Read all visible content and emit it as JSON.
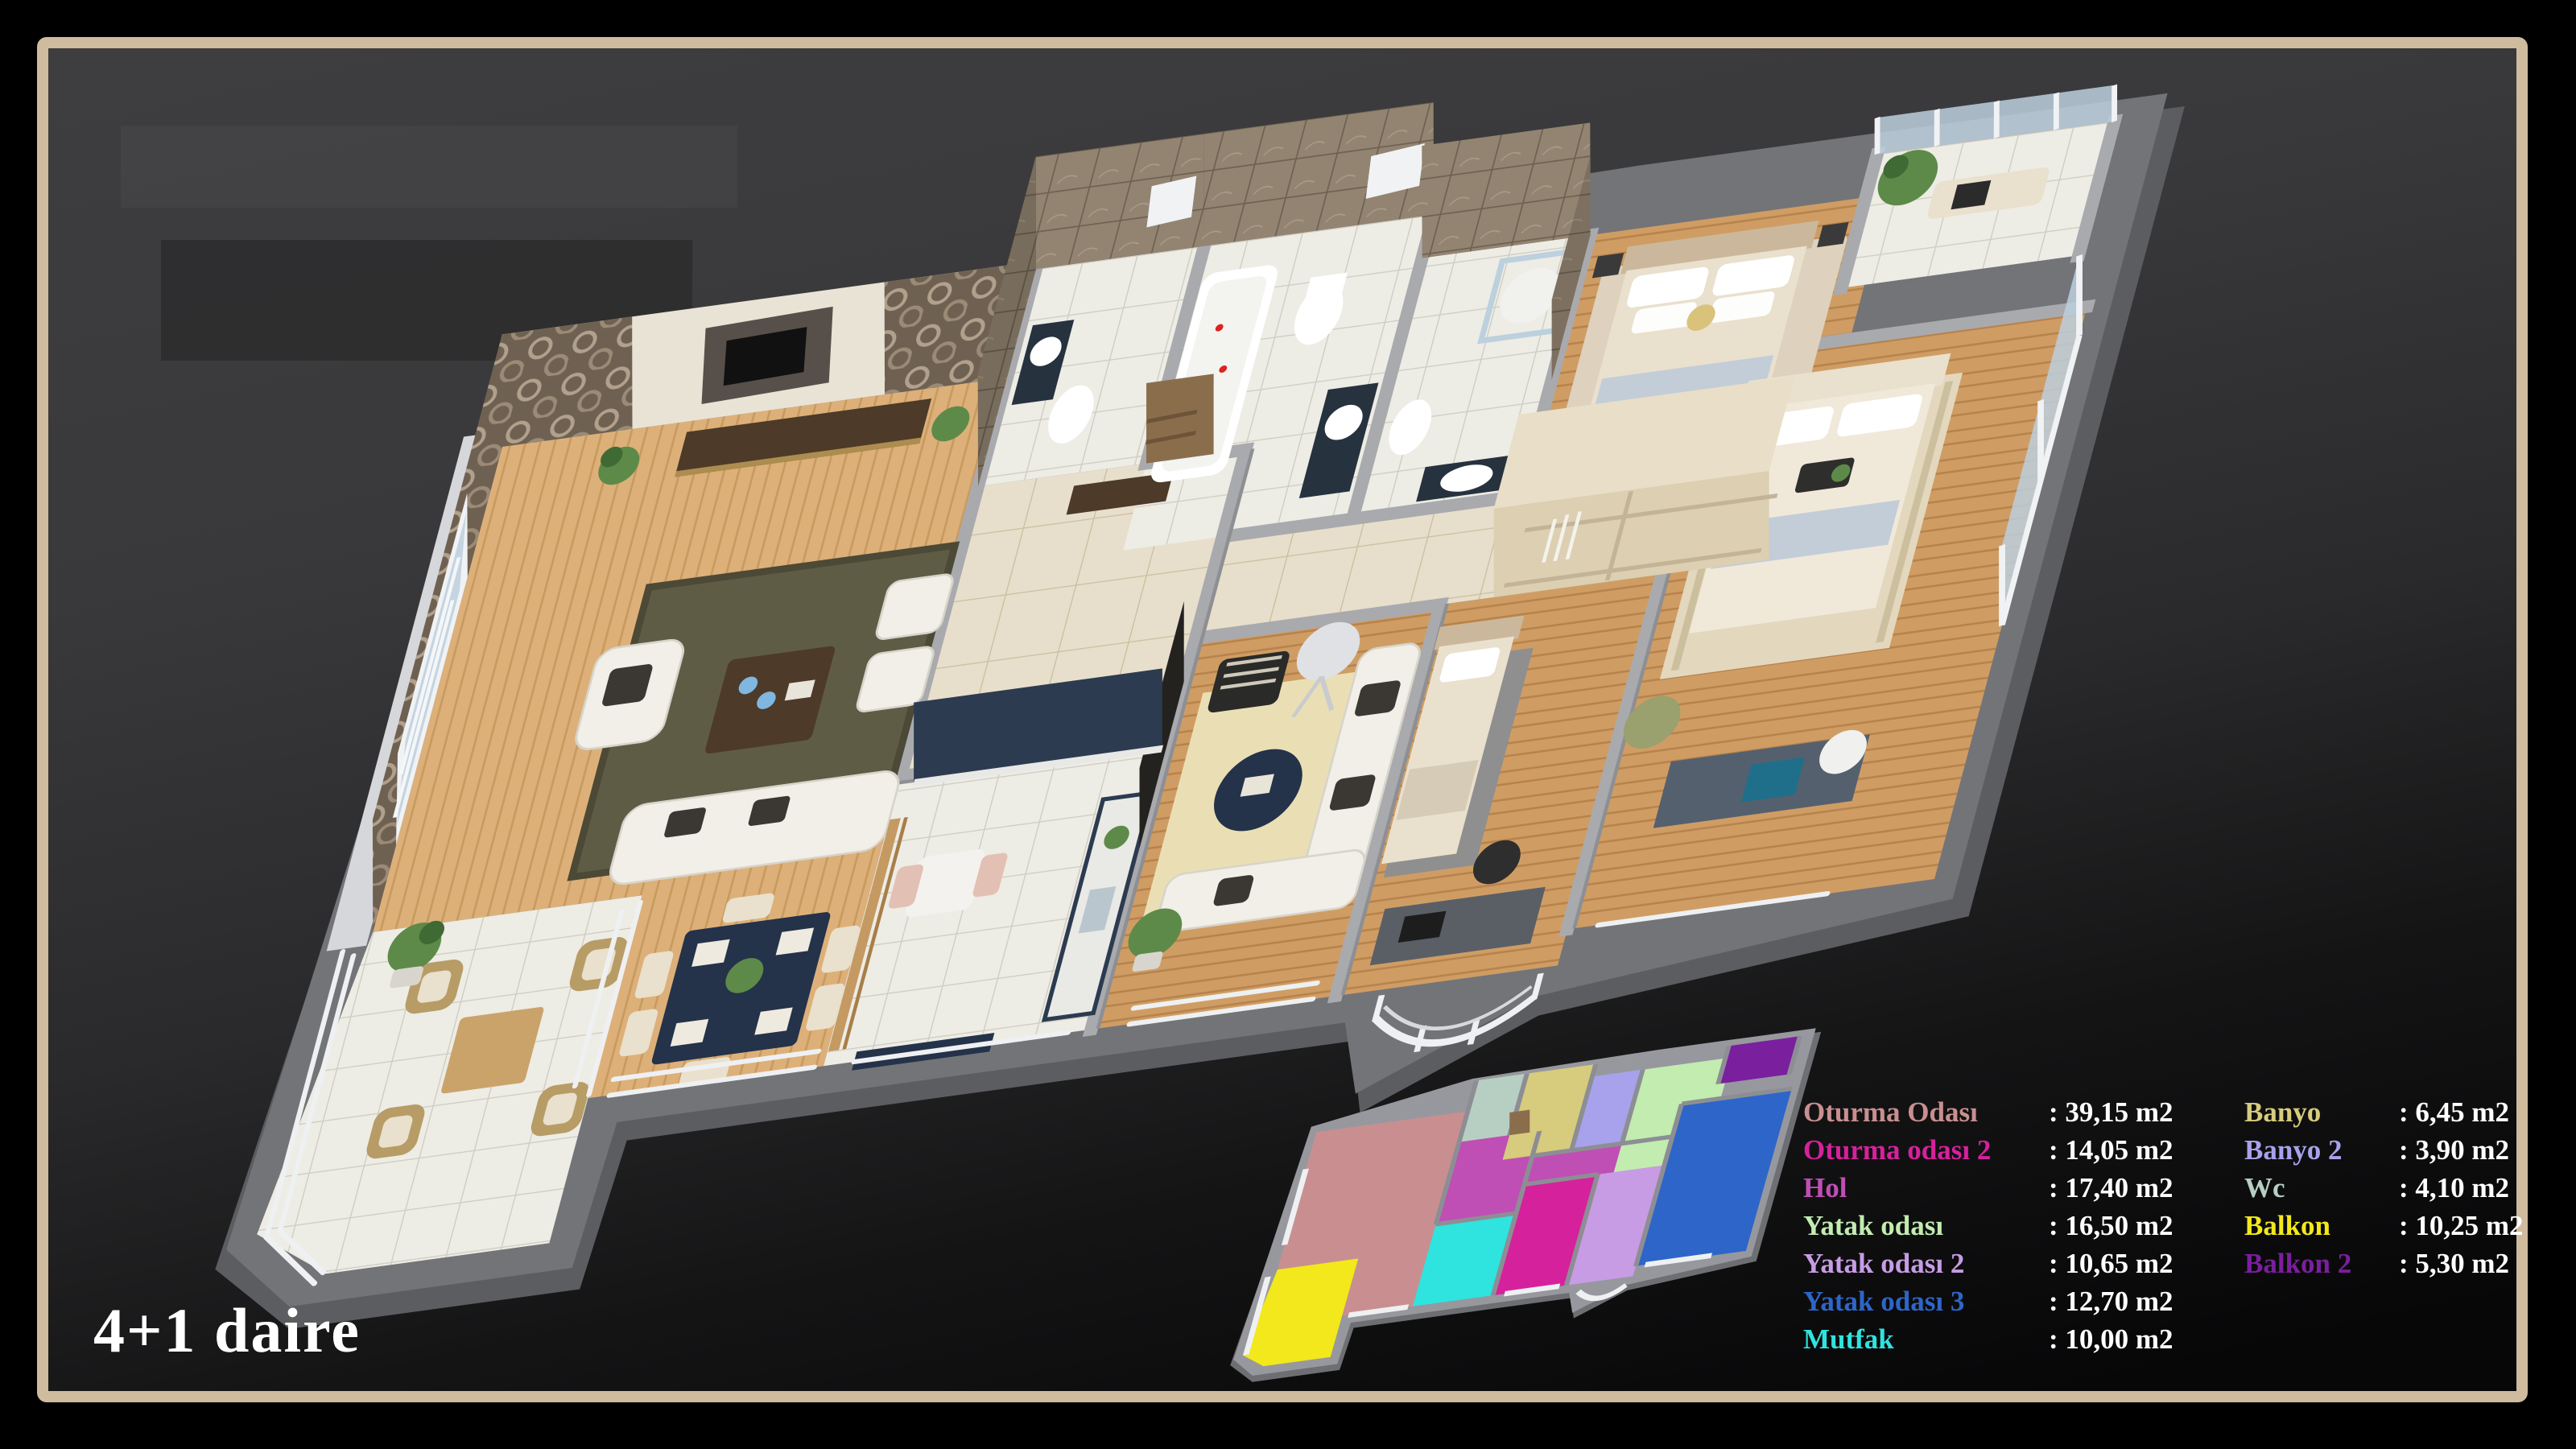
{
  "title": "4+1 daire",
  "legend": {
    "left": [
      {
        "key": "oturma1",
        "label": "Oturma Odası",
        "value": ": 39,15 m2",
        "color": "#c98f90"
      },
      {
        "key": "oturma2",
        "label": "Oturma odası 2",
        "value": ": 14,05 m2",
        "color": "#d6219c"
      },
      {
        "key": "hol",
        "label": "Hol",
        "value": ": 17,40 m2",
        "color": "#bf4fb4"
      },
      {
        "key": "yatak1",
        "label": "Yatak odası",
        "value": ": 16,50 m2",
        "color": "#c2ecb0"
      },
      {
        "key": "yatak2",
        "label": "Yatak odası 2",
        "value": ": 10,65 m2",
        "color": "#c79ce4"
      },
      {
        "key": "yatak3",
        "label": "Yatak odası 3",
        "value": ": 12,70 m2",
        "color": "#2d66c8"
      },
      {
        "key": "mutfak",
        "label": "Mutfak",
        "value": ": 10,00 m2",
        "color": "#2fe3df"
      }
    ],
    "right": [
      {
        "key": "banyo",
        "label": "Banyo",
        "value": ": 6,45 m2",
        "color": "#d7cb7d"
      },
      {
        "key": "banyo2",
        "label": "Banyo 2",
        "value": ": 3,90 m2",
        "color": "#a8a2ec"
      },
      {
        "key": "wc",
        "label": "Wc",
        "value": ": 4,10 m2",
        "color": "#b7cfc3"
      },
      {
        "key": "balkon",
        "label": "Balkon",
        "value": ": 10,25 m2",
        "color": "#f2e81c"
      },
      {
        "key": "balkon2",
        "label": "Balkon 2",
        "value": ": 5,30 m2",
        "color": "#7a1f9e"
      }
    ]
  }
}
